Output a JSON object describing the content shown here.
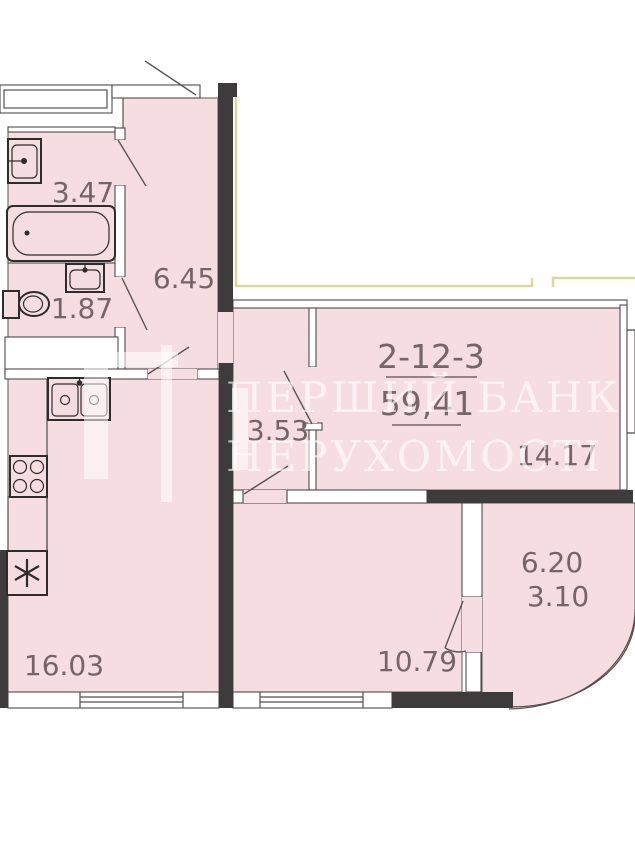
{
  "plan": {
    "apartment_label": "2-12-3",
    "total_area": "59,41",
    "room_areas": {
      "bathroom": "3.47",
      "hallway": "6.45",
      "wc": "1.87",
      "corridor": "3.53",
      "living_room": "14.17",
      "balcony_full": "6.20",
      "balcony_reduced": "3.10",
      "bedroom": "10.79",
      "kitchen_living": "16.03"
    },
    "fixtures": [
      "bathroom-sink",
      "bathtub",
      "toilet",
      "wc-sink",
      "kitchen-double-sink",
      "stove-4-burner",
      "fridge"
    ],
    "colors": {
      "room_fill": "#f6dde1",
      "wall_black": "#3d3b3c",
      "outline": "#4f4a4b",
      "label_text": "#766568",
      "exterior_line": "#d9d99e",
      "watermark": "rgba(255,255,255,0.6)"
    }
  },
  "watermark": {
    "line1": "ПЕРШИЙ БАНК",
    "line2": "НЕРУХОМОСТІ"
  }
}
